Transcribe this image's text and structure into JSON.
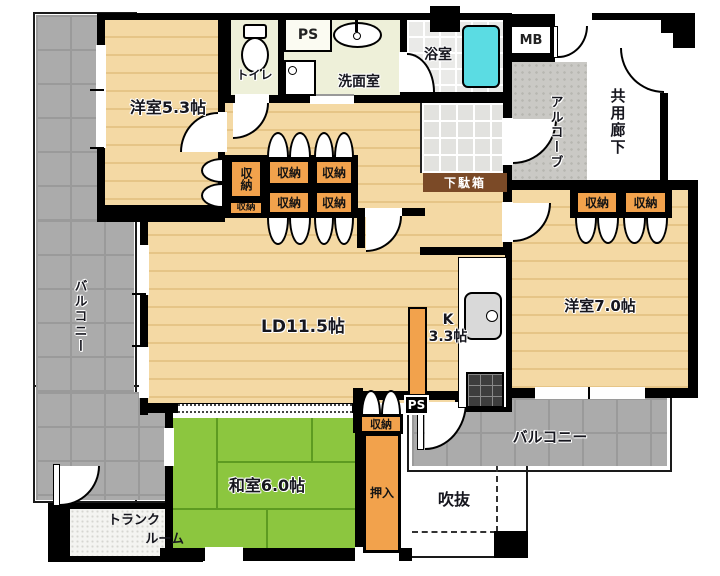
{
  "labels": {
    "yoshitsu53": "洋室5.3帖",
    "toilet": "トイレ",
    "ps": "PS",
    "senmen": "洗面室",
    "bath": "浴室",
    "mb": "MB",
    "alcove": "アルコーブ",
    "corridor": "共用廊下",
    "getabako": "下駄箱",
    "storage": "収納",
    "balcony": "バルコニー",
    "ld": "LD11.5帖",
    "k_line1": "K",
    "k_line2": "3.3帖",
    "yoshitsu70": "洋室7.0帖",
    "washitsu": "和室6.0帖",
    "oshiire": "押入",
    "fukinuke": "吹抜",
    "trunk_line1": "トランク",
    "trunk_line2": "ルーム"
  },
  "colors": {
    "wall": "#000000",
    "wood": "#f4d9a4",
    "wood_line": "#e6c587",
    "tatami": "#8cc63f",
    "tatami_line": "#5d9b21",
    "balcony": "#ababab",
    "balcony_line": "#9a9a9a",
    "pale": "#eef0d9",
    "tile_bath": "#eaeae8",
    "genkan": "#e2e2df",
    "alcove": "#cac9c5",
    "storage": "#f2a24c",
    "brown": "#7b4a27",
    "tub": "#5bdce3",
    "stove": "#3d3d3d"
  }
}
